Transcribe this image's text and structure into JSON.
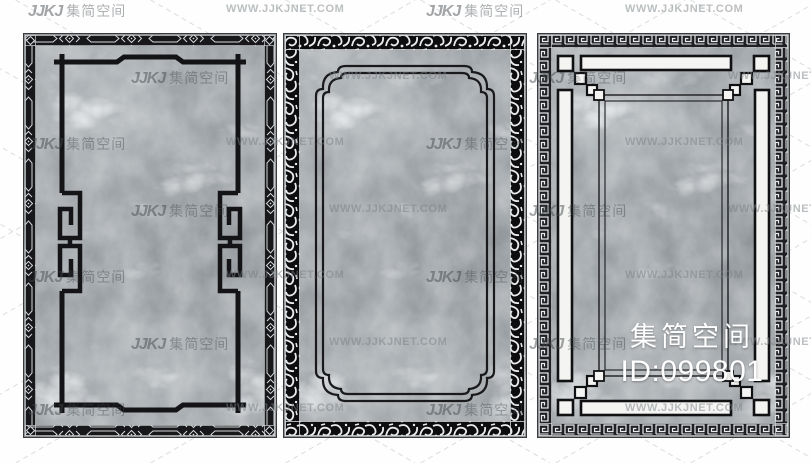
{
  "watermark": {
    "brand_logo": "JJKJ",
    "brand_name": "集简空间",
    "site": "WWW.JJKJNET.COM"
  },
  "overlay": {
    "studio": "集简空间",
    "image_id": "ID:099801"
  },
  "colors": {
    "marble_base": "#9ba0a4",
    "marble_vein": "#eef0f1",
    "ink_black": "#141416",
    "band_black": "#18181b",
    "ornament_white": "#e9ebec",
    "bar_white": "#f4f4f2",
    "overlay_text": "#ffffff",
    "dashed_guide": "#c9cbcc"
  }
}
